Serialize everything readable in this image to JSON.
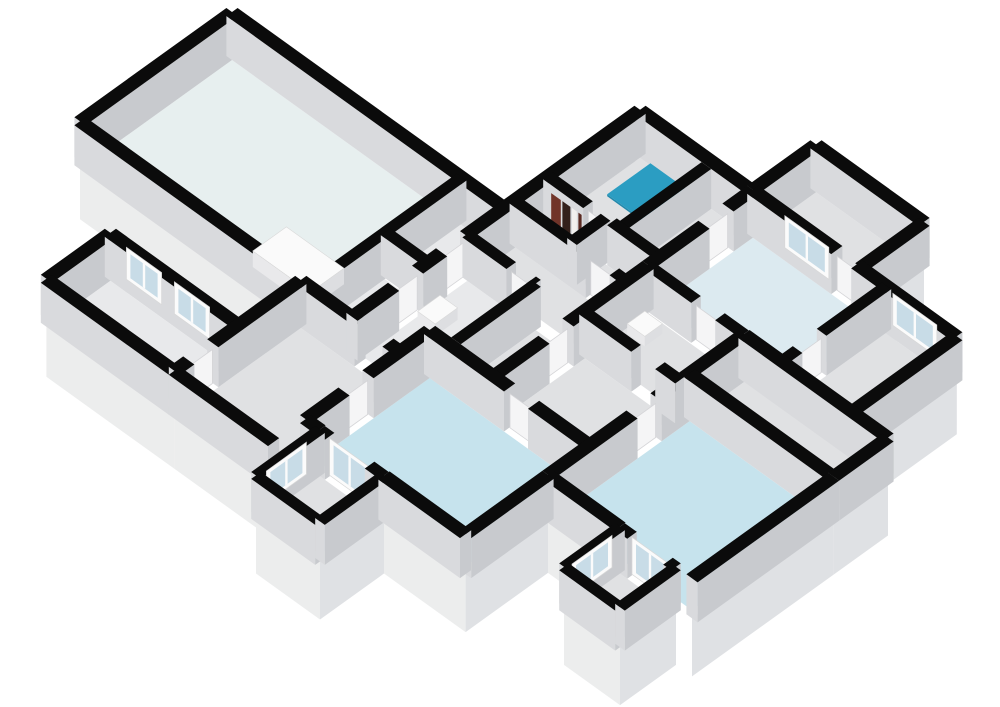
{
  "meta": {
    "view_name": "3d-floorplan-overview",
    "canvas": {
      "width": 1000,
      "height": 707,
      "background": "#ffffff"
    }
  },
  "projection": {
    "a": 0.8,
    "b": 0.575,
    "ox": 232,
    "oy": 52,
    "wall_height": 40,
    "base_drop": 58
  },
  "palette": {
    "wall_cap": "#0b0b0b",
    "wall_face_sw": "#d9dadd",
    "wall_face_se": "#c8cace",
    "base_face_sw": "#eceded",
    "base_face_se": "#dfe1e4",
    "floor_pale": "#e7efef",
    "floor_blue": "#c6e3ed",
    "floor_lightblue": "#dceaf0",
    "floor_gray": "#e0e1e3",
    "floor_white": "#e8e9eb",
    "shower_teal": "#2b9dc2",
    "shower_teal_side": "#2389ac",
    "glass": "#c8dce7",
    "frame_white": "#fbfbfb",
    "door_leaf": "#f5f5f6",
    "door_edge": "#d5d5d8",
    "fixture_top": "#fafafa",
    "fixture_side_s": "#e9e9eb",
    "fixture_side_e": "#dddee1"
  },
  "floorplan": {
    "blocks": [
      {
        "name": "living-wing-slab",
        "rect": [
          0,
          0,
          340,
          190
        ],
        "faces": [
          [
            "S",
            0,
            276
          ]
        ]
      },
      {
        "name": "north-center-slab-w",
        "rect": [
          340,
          -170,
          400,
          190
        ],
        "faces": []
      },
      {
        "name": "north-center-slab-e",
        "rect": [
          400,
          -170,
          480,
          153
        ],
        "faces": []
      },
      {
        "name": "top-right-room-slab",
        "rect": [
          480,
          -250,
          615,
          -171
        ],
        "faces": [
          [
            "E",
            -250,
            -171
          ]
        ]
      },
      {
        "name": "right-wing-slab",
        "rect": [
          480,
          -171,
          735,
          -40
        ],
        "faces": [
          [
            "S",
            600,
            735
          ],
          [
            "E",
            -171,
            -40
          ]
        ]
      },
      {
        "name": "mid-corridor-slab",
        "rect": [
          480,
          -40,
          600,
          153
        ],
        "faces": []
      },
      {
        "name": "east-corridor-slab",
        "rect": [
          600,
          -40,
          780,
          28
        ],
        "faces": [
          [
            "E",
            -40,
            28
          ]
        ]
      },
      {
        "name": "bedroom-se-slab",
        "rect": [
          600,
          28,
          780,
          205
        ],
        "faces": [
          [
            "S",
            600,
            690
          ],
          [
            "E",
            28,
            205
          ]
        ]
      },
      {
        "name": "hall-west-slab",
        "rect": [
          276,
          190,
          400,
          348
        ],
        "faces": [
          [
            "S",
            276,
            400
          ],
          [
            "E",
            308,
            348
          ]
        ]
      },
      {
        "name": "bedroom-sw-slab",
        "rect": [
          400,
          153,
          600,
          308
        ],
        "faces": [
          [
            "S",
            400,
            418
          ],
          [
            "S",
            498,
            600
          ],
          [
            "E",
            205,
            308
          ]
        ]
      },
      {
        "name": "annex-slab",
        "rect": [
          116,
          268,
          276,
          348
        ],
        "faces": [
          [
            "S",
            116,
            276
          ]
        ]
      },
      {
        "name": "balcony-sw-slab",
        "rect": [
          418,
          308,
          498,
          388
        ],
        "faces": [
          [
            "S",
            418,
            498
          ],
          [
            "E",
            308,
            388
          ]
        ]
      },
      {
        "name": "balcony-se-slab",
        "rect": [
          690,
          205,
          760,
          275
        ],
        "faces": [
          [
            "S",
            690,
            760
          ],
          [
            "E",
            205,
            275
          ]
        ]
      }
    ],
    "floors": [
      {
        "name": "living-room-floor",
        "rect": [
          7,
          7,
          281,
          183
        ],
        "color": "floor_pale"
      },
      {
        "name": "closet-a-floor",
        "rect": [
          293,
          7,
          333,
          88
        ],
        "color": "floor_white"
      },
      {
        "name": "closet-b-floor",
        "rect": [
          293,
          102,
          333,
          183
        ],
        "color": "floor_white"
      },
      {
        "name": "bathroom-floor",
        "rect": [
          347,
          -163,
          424,
          -62
        ],
        "color": "floor_gray"
      },
      {
        "name": "bath-east-cell-floor",
        "rect": [
          436,
          -163,
          473,
          -62
        ],
        "color": "floor_gray"
      },
      {
        "name": "striped-closet-floor",
        "rect": [
          346,
          -49,
          406,
          -19
        ],
        "color": "floor_gray"
      },
      {
        "name": "north-hall-floor",
        "rect": [
          418,
          -49,
          473,
          -19
        ],
        "color": "floor_gray"
      },
      {
        "name": "upper-corridor-floor",
        "rect": [
          346,
          -7,
          473,
          40
        ],
        "color": "floor_gray"
      },
      {
        "name": "wc-floor",
        "rect": [
          346,
          52,
          420,
          183
        ],
        "color": "floor_white"
      },
      {
        "name": "corridor-east-floor",
        "rect": [
          432,
          52,
          473,
          146
        ],
        "color": "floor_gray"
      },
      {
        "name": "wash-room-floor",
        "rect": [
          487,
          -33,
          593,
          34
        ],
        "color": "floor_gray"
      },
      {
        "name": "mid-corridor-floor",
        "rect": [
          487,
          46,
          593,
          146
        ],
        "color": "floor_gray"
      },
      {
        "name": "utility-room-floor",
        "rect": [
          487,
          -164,
          641,
          -47
        ],
        "color": "floor_lightblue"
      },
      {
        "name": "gray-room-east-floor",
        "rect": [
          653,
          -164,
          728,
          -47
        ],
        "color": "floor_gray"
      },
      {
        "name": "top-right-room-floor",
        "rect": [
          487,
          -243,
          608,
          -178
        ],
        "color": "floor_gray"
      },
      {
        "name": "east-corridor-floor",
        "rect": [
          607,
          -33,
          773,
          21
        ],
        "color": "floor_gray"
      },
      {
        "name": "bedroom-se-floor",
        "rect": [
          607,
          35,
          773,
          198
        ],
        "color": "floor_blue"
      },
      {
        "name": "bedroom-sw-floor",
        "rect": [
          407,
          160,
          593,
          301
        ],
        "color": "floor_blue"
      },
      {
        "name": "hall-west-floor",
        "rect": [
          283,
          197,
          393,
          341
        ],
        "color": "floor_gray"
      },
      {
        "name": "annex-floor",
        "rect": [
          123,
          275,
          269,
          341
        ],
        "color": "floor_white"
      },
      {
        "name": "balcony-sw-floor",
        "rect": [
          424,
          314,
          492,
          382
        ],
        "color": "floor_gray"
      },
      {
        "name": "balcony-se-floor",
        "rect": [
          696,
          211,
          754,
          269
        ],
        "color": "floor_gray"
      }
    ],
    "walls": [
      [
        0,
        0,
        340,
        0,
        14
      ],
      [
        0,
        0,
        0,
        190,
        14
      ],
      [
        0,
        190,
        276,
        190,
        14
      ],
      [
        340,
        -170,
        340,
        48,
        14
      ],
      [
        340,
        78,
        340,
        108,
        14
      ],
      [
        340,
        138,
        340,
        190,
        14
      ],
      [
        287,
        0,
        287,
        190,
        12
      ],
      [
        287,
        95,
        340,
        95,
        12
      ],
      [
        340,
        -170,
        480,
        -170,
        14
      ],
      [
        430,
        -163,
        430,
        -55,
        12
      ],
      [
        340,
        -55,
        390,
        -55,
        12
      ],
      [
        420,
        -55,
        480,
        -55,
        12
      ],
      [
        340,
        -13,
        435,
        -13,
        12
      ],
      [
        465,
        -13,
        480,
        -13,
        12
      ],
      [
        412,
        -55,
        412,
        -13,
        12
      ],
      [
        340,
        46,
        395,
        46,
        12
      ],
      [
        420,
        46,
        426,
        46,
        12
      ],
      [
        426,
        46,
        426,
        146,
        12
      ],
      [
        400,
        153,
        500,
        153,
        14
      ],
      [
        530,
        153,
        600,
        153,
        14
      ],
      [
        276,
        190,
        350,
        190,
        14
      ],
      [
        385,
        190,
        400,
        190,
        14
      ],
      [
        480,
        -171,
        480,
        -140,
        14
      ],
      [
        480,
        -110,
        480,
        -40,
        14
      ],
      [
        480,
        -40,
        480,
        60,
        14
      ],
      [
        480,
        90,
        480,
        153,
        14
      ],
      [
        480,
        -171,
        585,
        -171,
        14
      ],
      [
        610,
        -171,
        735,
        -171,
        14
      ],
      [
        735,
        -171,
        735,
        -40,
        14
      ],
      [
        600,
        -40,
        780,
        -40,
        14
      ],
      [
        480,
        -40,
        540,
        -40,
        12
      ],
      [
        570,
        -40,
        600,
        -40,
        12
      ],
      [
        647,
        -171,
        647,
        -90,
        12
      ],
      [
        647,
        -60,
        647,
        -40,
        12
      ],
      [
        480,
        -250,
        615,
        -250,
        14
      ],
      [
        480,
        -250,
        480,
        -171,
        14
      ],
      [
        615,
        -250,
        615,
        -171,
        14
      ],
      [
        480,
        40,
        545,
        40,
        12
      ],
      [
        575,
        40,
        600,
        40,
        12
      ],
      [
        600,
        -40,
        600,
        70,
        14
      ],
      [
        600,
        100,
        600,
        205,
        14
      ],
      [
        780,
        -40,
        780,
        28,
        14
      ],
      [
        600,
        28,
        780,
        28,
        14
      ],
      [
        780,
        28,
        780,
        205,
        14
      ],
      [
        600,
        205,
        690,
        205,
        14
      ],
      [
        690,
        205,
        705,
        205,
        12
      ],
      [
        750,
        205,
        760,
        205,
        12
      ],
      [
        400,
        153,
        400,
        230,
        14
      ],
      [
        400,
        260,
        400,
        308,
        14
      ],
      [
        400,
        308,
        418,
        308,
        14
      ],
      [
        498,
        308,
        600,
        308,
        14
      ],
      [
        600,
        205,
        600,
        308,
        14
      ],
      [
        418,
        308,
        430,
        308,
        12
      ],
      [
        480,
        308,
        498,
        308,
        12
      ],
      [
        276,
        190,
        276,
        300,
        14
      ],
      [
        276,
        330,
        276,
        348,
        14
      ],
      [
        276,
        348,
        400,
        348,
        14
      ],
      [
        116,
        268,
        276,
        268,
        14
      ],
      [
        116,
        268,
        116,
        348,
        14
      ],
      [
        116,
        348,
        276,
        348,
        14
      ],
      [
        418,
        308,
        418,
        388,
        12
      ],
      [
        418,
        388,
        498,
        388,
        12
      ],
      [
        498,
        308,
        498,
        388,
        12
      ],
      [
        690,
        205,
        690,
        275,
        12
      ],
      [
        690,
        275,
        760,
        275,
        12
      ],
      [
        760,
        205,
        760,
        275,
        12
      ]
    ],
    "doors": [
      {
        "name": "closet-a-door",
        "line": [
          340,
          48,
          340,
          78
        ]
      },
      {
        "name": "closet-b-door",
        "line": [
          340,
          108,
          340,
          138
        ]
      },
      {
        "name": "bathroom-door",
        "line": [
          390,
          -55,
          420,
          -55
        ]
      },
      {
        "name": "north-hall-door",
        "line": [
          435,
          -13,
          465,
          -13
        ]
      },
      {
        "name": "bedroom-sw-door",
        "line": [
          500,
          153,
          530,
          153
        ]
      },
      {
        "name": "bedroom-se-door",
        "line": [
          600,
          70,
          600,
          100
        ]
      },
      {
        "name": "hall-west-door",
        "line": [
          400,
          230,
          400,
          260
        ]
      },
      {
        "name": "annex-door",
        "line": [
          276,
          300,
          276,
          330
        ]
      },
      {
        "name": "wash-room-door",
        "line": [
          540,
          -40,
          570,
          -40
        ]
      },
      {
        "name": "utility-room-door",
        "line": [
          647,
          -90,
          647,
          -60
        ]
      },
      {
        "name": "corridor-door",
        "line": [
          480,
          60,
          480,
          90
        ]
      },
      {
        "name": "right-wing-door",
        "line": [
          480,
          -140,
          480,
          -110
        ]
      },
      {
        "name": "wc-door",
        "line": [
          395,
          46,
          420,
          46
        ]
      },
      {
        "name": "top-right-door",
        "line": [
          585,
          -171,
          610,
          -171
        ]
      }
    ],
    "windows": [
      {
        "name": "annex-window-1",
        "line": [
          136,
          268,
          180,
          268
        ],
        "k": 464.5
      },
      {
        "name": "annex-window-2",
        "line": [
          196,
          268,
          240,
          268
        ],
        "k": 464.6
      },
      {
        "name": "right-wing-window-1",
        "line": [
          520,
          -171,
          575,
          -171
        ],
        "k": 362
      },
      {
        "name": "right-wing-window-2",
        "line": [
          655,
          -171,
          710,
          -171
        ],
        "k": 502
      },
      {
        "name": "balcony-sw-window",
        "line": [
          418,
          325,
          418,
          375
        ],
        "k": 766.5
      },
      {
        "name": "balcony-se-window",
        "line": [
          690,
          215,
          690,
          265
        ],
        "k": 930.5
      }
    ],
    "french_doors": [
      {
        "name": "balcony-sw-french-door",
        "line": [
          430,
          308,
          480,
          308
        ]
      },
      {
        "name": "balcony-se-french-door",
        "line": [
          705,
          205,
          750,
          205
        ]
      }
    ],
    "fixtures": [
      {
        "name": "kitchen-counter",
        "rect": [
          200,
          132,
          272,
          174
        ],
        "h": 16,
        "style": "white"
      },
      {
        "name": "shower-tray",
        "rect": [
          360,
          -163,
          414,
          -109
        ],
        "h": 2,
        "style": "teal"
      },
      {
        "name": "toilet",
        "rect": [
          352,
          92,
          374,
          120
        ],
        "h": 12,
        "style": "white"
      },
      {
        "name": "wall-sink-1",
        "rect": [
          492,
          -24,
          514,
          -2
        ],
        "h": 10,
        "style": "white"
      },
      {
        "name": "wall-sink-2",
        "rect": [
          594,
          -70,
          618,
          -48
        ],
        "h": 10,
        "style": "white"
      }
    ],
    "stripes": [
      {
        "name": "closet-shelf-stripe",
        "line": [
          350,
          -49,
          362,
          -49
        ],
        "z": [
          0,
          32
        ],
        "color": "#713429",
        "k": 310.5
      },
      {
        "name": "closet-shelf-stripe",
        "line": [
          364,
          -49,
          374,
          -49
        ],
        "z": [
          0,
          32
        ],
        "color": "#33201b",
        "k": 310.6
      },
      {
        "name": "closet-shelf-stripe",
        "line": [
          376,
          -49,
          382,
          -49
        ],
        "z": [
          0,
          32
        ],
        "color": "#f2f0ee",
        "k": 310.7
      },
      {
        "name": "closet-shelf-stripe",
        "line": [
          384,
          -49,
          388,
          -49
        ],
        "z": [
          0,
          32
        ],
        "color": "#5a2a22",
        "k": 310.8
      }
    ]
  }
}
